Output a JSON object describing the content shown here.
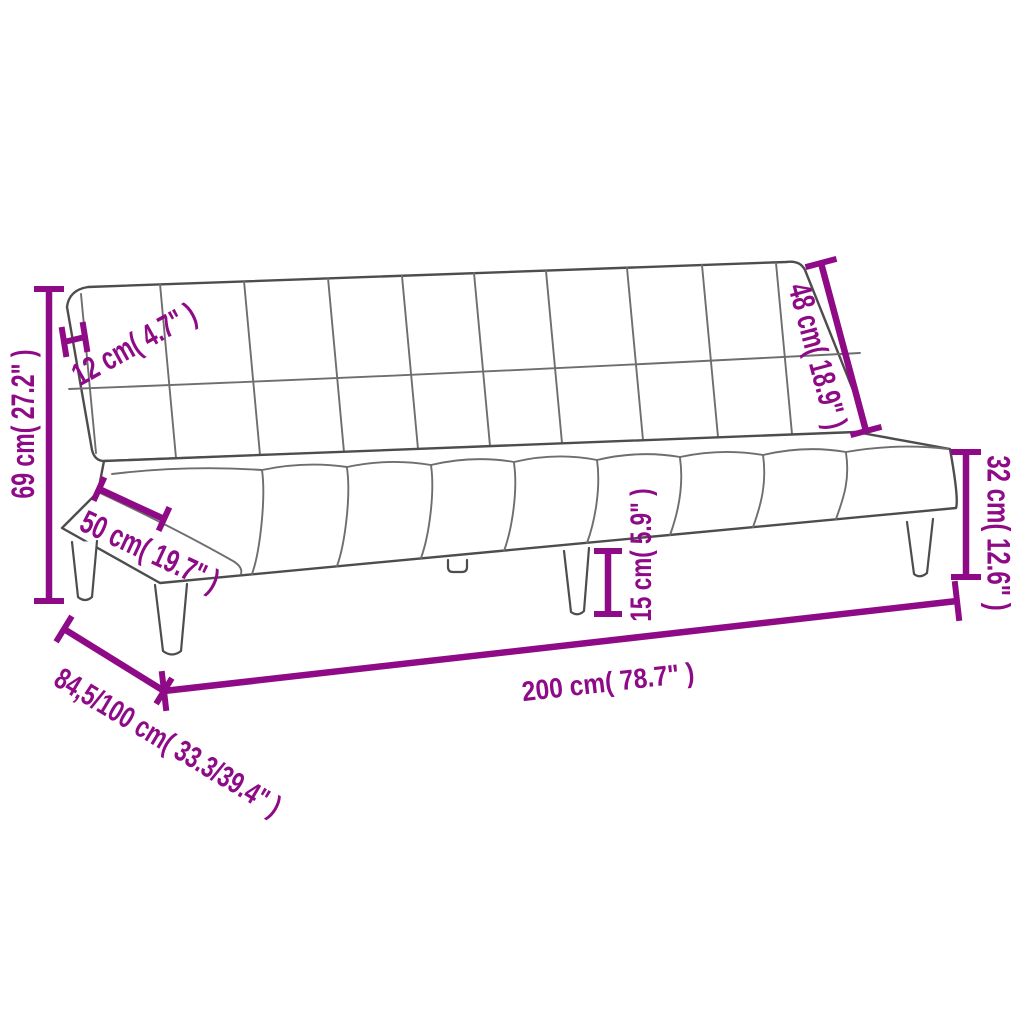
{
  "diagram": {
    "subject": "sofa-bed-line-drawing",
    "dimensions": {
      "total_height": "69 cm( 27.2\" )",
      "backrest_thickness": "12 cm( 4.7\" )",
      "backrest_length": "48 cm( 18.9\" )",
      "seat_depth": "50 cm( 19.7\" )",
      "seat_height": "32 cm( 12.6\" )",
      "leg_height": "15 cm( 5.9\" )",
      "total_width": "200 cm( 78.7\" )",
      "depth_folded_unfolded": "84,5/100 cm( 33.3/39.4\" )"
    },
    "colors": {
      "dimension_accent": "#8E0A86",
      "sofa_outline": "#4D4D4D",
      "background": "#FFFFFF"
    }
  }
}
